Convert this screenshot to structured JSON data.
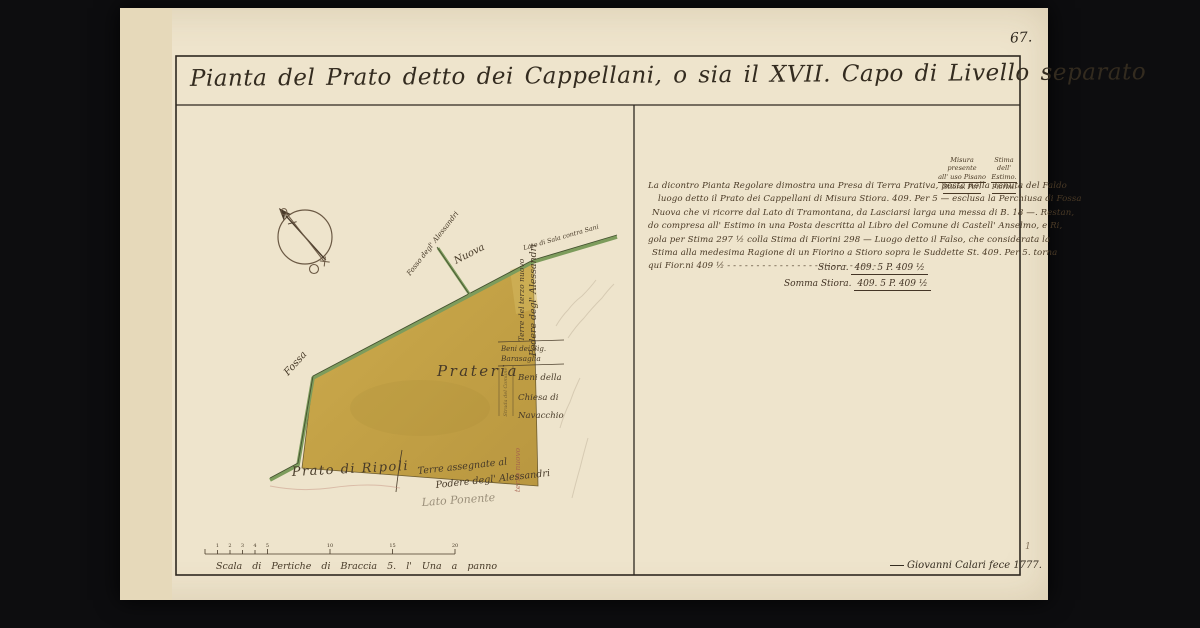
{
  "page": {
    "folio_number": "67.",
    "corner_mark": "1"
  },
  "title": {
    "text": "Pianta del Prato detto dei Cappellani, o sia il XVII. Capo di Livello separato"
  },
  "map": {
    "parcel_label": "Prateria",
    "labels": {
      "fossa": "Fossa",
      "nuova": "Nuova",
      "fosso_alessandri": "Fosso degl' Alessandri",
      "lato_sala": "Lato di Sala contra Sani",
      "terre_terzo_nuovo": "Terre del terzo nuovo",
      "podere_alessandri": "Podere degl' Alessandri",
      "beni_line1": "Beni dei Sig.",
      "beni_line2": "Barasaglia",
      "strada_strip": "Strada del Comune",
      "chiesa_line1": "Beni della",
      "chiesa_line2": "Chiesa di",
      "chiesa_line3": "Navacchio",
      "terzo_nuovo": "terzo nuovo",
      "prato_ripoli": "Prato di Ripoli",
      "terre_assegnate_line1": "Terre assegnate al",
      "terre_assegnate_line2": "Podere degl' Alessandri",
      "lato_ponente": "Lato Ponente"
    }
  },
  "note": {
    "col1": [
      "Misura presente",
      "all' uso Pisano",
      "Stiora. Per:"
    ],
    "col2": [
      "Stima",
      "dell'",
      "Estimo.",
      "Fiorini."
    ],
    "lines": [
      "La dicontro Pianta Regolare dimostra una Presa di Terra Prativa, posta nella Tenuta del Faldo",
      "luogo detto il Prato dei Cappellani di Misura Stiora. 409. Per 5 — esclusa la Perchiusa di Fossa",
      "Nuova che vi ricorre dal Lato di Tramontana, da Lasciarsi larga una messa di B. 18 —. Restan,",
      "do compresa all' Estimo in una Posta descritta al Libro del Comune di Castell' Anselmo, e Ri,",
      "gola per Stima 297 ½ colla Stima di Fiorini 298 — Luogo detto il Falso, che considerata la",
      "Stima alla medesima Ragione di un Fiorino a Stioro sopra le Suddette St. 409. Per 5. torna",
      "qui Fior.ni 409 ½  - - - - - - - - - - - - - - - - - - - - - - - - - -"
    ],
    "totals": [
      {
        "label": "Stiora.",
        "value": "409. 5 P. 409 ½"
      },
      {
        "label": "Somma Stiora.",
        "value": "409. 5 P. 409 ½"
      }
    ]
  },
  "scale": {
    "caption": "Scala di Pertiche di Braccia 5. l' Una a panno",
    "minor_labels": [
      "1",
      "2",
      "3",
      "4",
      "5"
    ],
    "major_labels": [
      "10",
      "15",
      "20"
    ]
  },
  "signature": "Giovanni Calari fece 1777.",
  "colors": {
    "background": "#0d0d0f",
    "paper": "#eee4cc",
    "ink": "#3b3226",
    "parcel_ochre": "#c9a84d",
    "boundary_green": "#7d9c5c",
    "red_ink": "#a55f4d"
  }
}
